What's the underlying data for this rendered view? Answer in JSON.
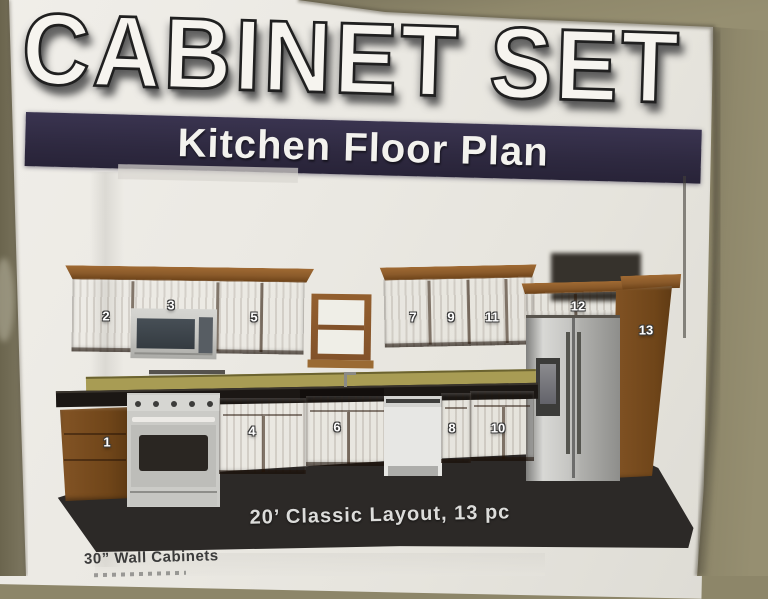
{
  "poster": {
    "title": "CABINET SET",
    "banner": "Kitchen Floor Plan",
    "caption": "20’ Classic Layout, 13 pc",
    "footer_line1": "30” Wall Cabinets",
    "cabinet_numbers": [
      "1",
      "2",
      "3",
      "4",
      "5",
      "6",
      "7",
      "8",
      "9",
      "10",
      "11",
      "12",
      "13"
    ]
  },
  "colors": {
    "wall": "#8d8669",
    "paper": "#eae8e2",
    "banner_bg": "#2e2940",
    "title_fill": "#f6f4ef",
    "cabinet_wood": "#7b4e21",
    "countertop": "#1b1714",
    "backsplash": "#a89c54",
    "floor": "#2c2927",
    "stainless": "#c6c6c2",
    "number_text": "#ffffff",
    "footer_text": "#3b3b3b"
  }
}
